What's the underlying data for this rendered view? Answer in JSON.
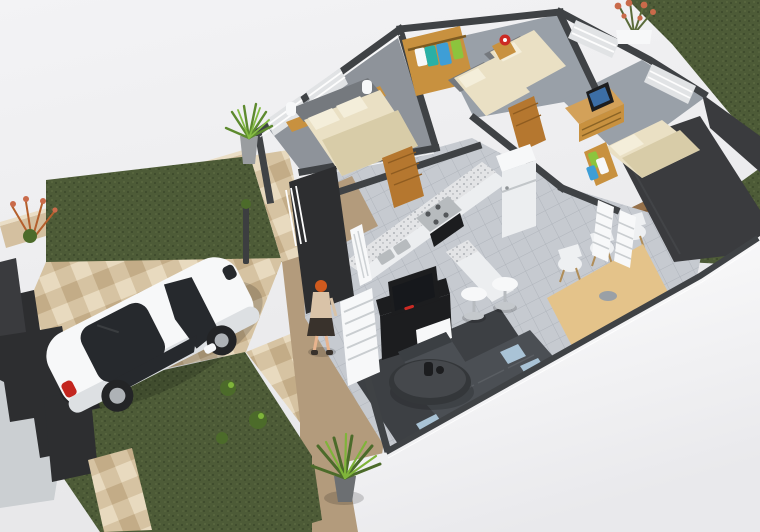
{
  "meta": {
    "title": "3D isometric cutaway floor plan render of a small house",
    "description": "Photorealistic 3D floor plan viewed from above: three bedrooms, kitchen with bar, living room with sectional sofa and TV unit, dining table with six chairs, front yard with grass, tiled driveway, white hatchback car and a woman walking to the entrance",
    "width": 760,
    "height": 532
  },
  "palette": {
    "bg_top": "#f2f2f4",
    "bg_mid": "#e9e9eb",
    "fore_white": "#fbfbfc",
    "fore_shade": "#e3e3e6",
    "grass_dark": "#3e4b2c",
    "grass_mid": "#4d5b37",
    "grass_light": "#5e6c43",
    "tile_light": "#e8dabf",
    "tile_mid": "#d6c3a2",
    "tile_dark": "#c3ac87",
    "tan_wall_face": "#d4c0a0",
    "tan_wall_top": "#eadec6",
    "entry_floor": "#b39b7c",
    "dark_wall": "#3a3b3e",
    "dark_wall2": "#2d2e30",
    "cap": "#3f4245",
    "wall_white": "#f3f4f5",
    "wall_light": "#e1e3e5",
    "wall_shade": "#cbcfd2",
    "floor_tile": "#c6cad0",
    "floor_line": "#b0b5bc",
    "carpet": "#8e939a",
    "carpet2": "#99a0a8",
    "rug": "#3d4044",
    "wood_door": "#b5772f",
    "wood_light": "#d3a159",
    "wood_dark": "#8f5c20",
    "wardrobe_wood": "#c8913f",
    "bed_cream": "#eae0c4",
    "bed_cream_shade": "#d8cca8",
    "pillow": "#f4eeda",
    "headboard": "#75797e",
    "bright_white": "#f7f8f9",
    "clothes_blue": "#3e9ed6",
    "clothes_green": "#8cc43d",
    "clothes_teal": "#2ab0a6",
    "counter_white": "#eceef0",
    "granite_base": "#e3e4e6",
    "granite_dot": "#9fa3a8",
    "steel": "#b7bbbe",
    "tv_black": "#1c1d1f",
    "red_accent": "#cc2a24",
    "sofa": "#4b4f54",
    "sofa_dark": "#3b3f43",
    "pillow_blue": "#a9c3d6",
    "table_wood": "#e4c38a",
    "chair_white": "#eef0f2",
    "chrome": "#c4c8cc",
    "deck_wood": "#96714b",
    "deck_line": "#7b5a38",
    "skin": "#e8b48e",
    "hair_orange": "#cf5a1e",
    "top_beige": "#d9c3a8",
    "skirt_dark": "#39322c",
    "car_white": "#f7f8f9",
    "car_shade": "#dde0e3",
    "car_glass": "#26292d",
    "wheel": "#232426",
    "rim": "#aeb2b6",
    "tail_red": "#c3261f",
    "leaf_green": "#7fb43a",
    "leaf_dark": "#4c6b2a",
    "plant_red": "#c96a4a"
  },
  "scene": {
    "vehicle": {
      "label": "white hatchback car",
      "count": 1
    },
    "person": {
      "label": "woman walking to entrance",
      "count": 1
    },
    "rooms": [
      {
        "label": "master bedroom",
        "furniture": [
          "double bed",
          "two wall lamps",
          "bedside shelf",
          "wardrobe with clothes"
        ]
      },
      {
        "label": "kids bedroom",
        "furniture": [
          "two single beds",
          "nightstand",
          "red wall decor",
          "louvered window"
        ]
      },
      {
        "label": "third bedroom",
        "furniture": [
          "double bed",
          "dresser with tv",
          "open wardrobe with clothes"
        ]
      },
      {
        "label": "kitchen",
        "furniture": [
          "l-counter with granite top",
          "stove and oven",
          "sink",
          "fridge",
          "bar counter",
          "2 bar stools"
        ]
      },
      {
        "label": "living room",
        "furniture": [
          "sectional sofa",
          "blue pillows",
          "round coffee table",
          "tv cabinet",
          "dark rug"
        ]
      },
      {
        "label": "dining room",
        "furniture": [
          "wood dining table",
          "6 white chairs"
        ]
      }
    ],
    "exterior": [
      "front lawn",
      "tiled driveway",
      "tan boundary wall",
      "dark stepped fence",
      "wood deck",
      "potted yucca plants",
      "red flowering plant",
      "white entry gate"
    ]
  }
}
